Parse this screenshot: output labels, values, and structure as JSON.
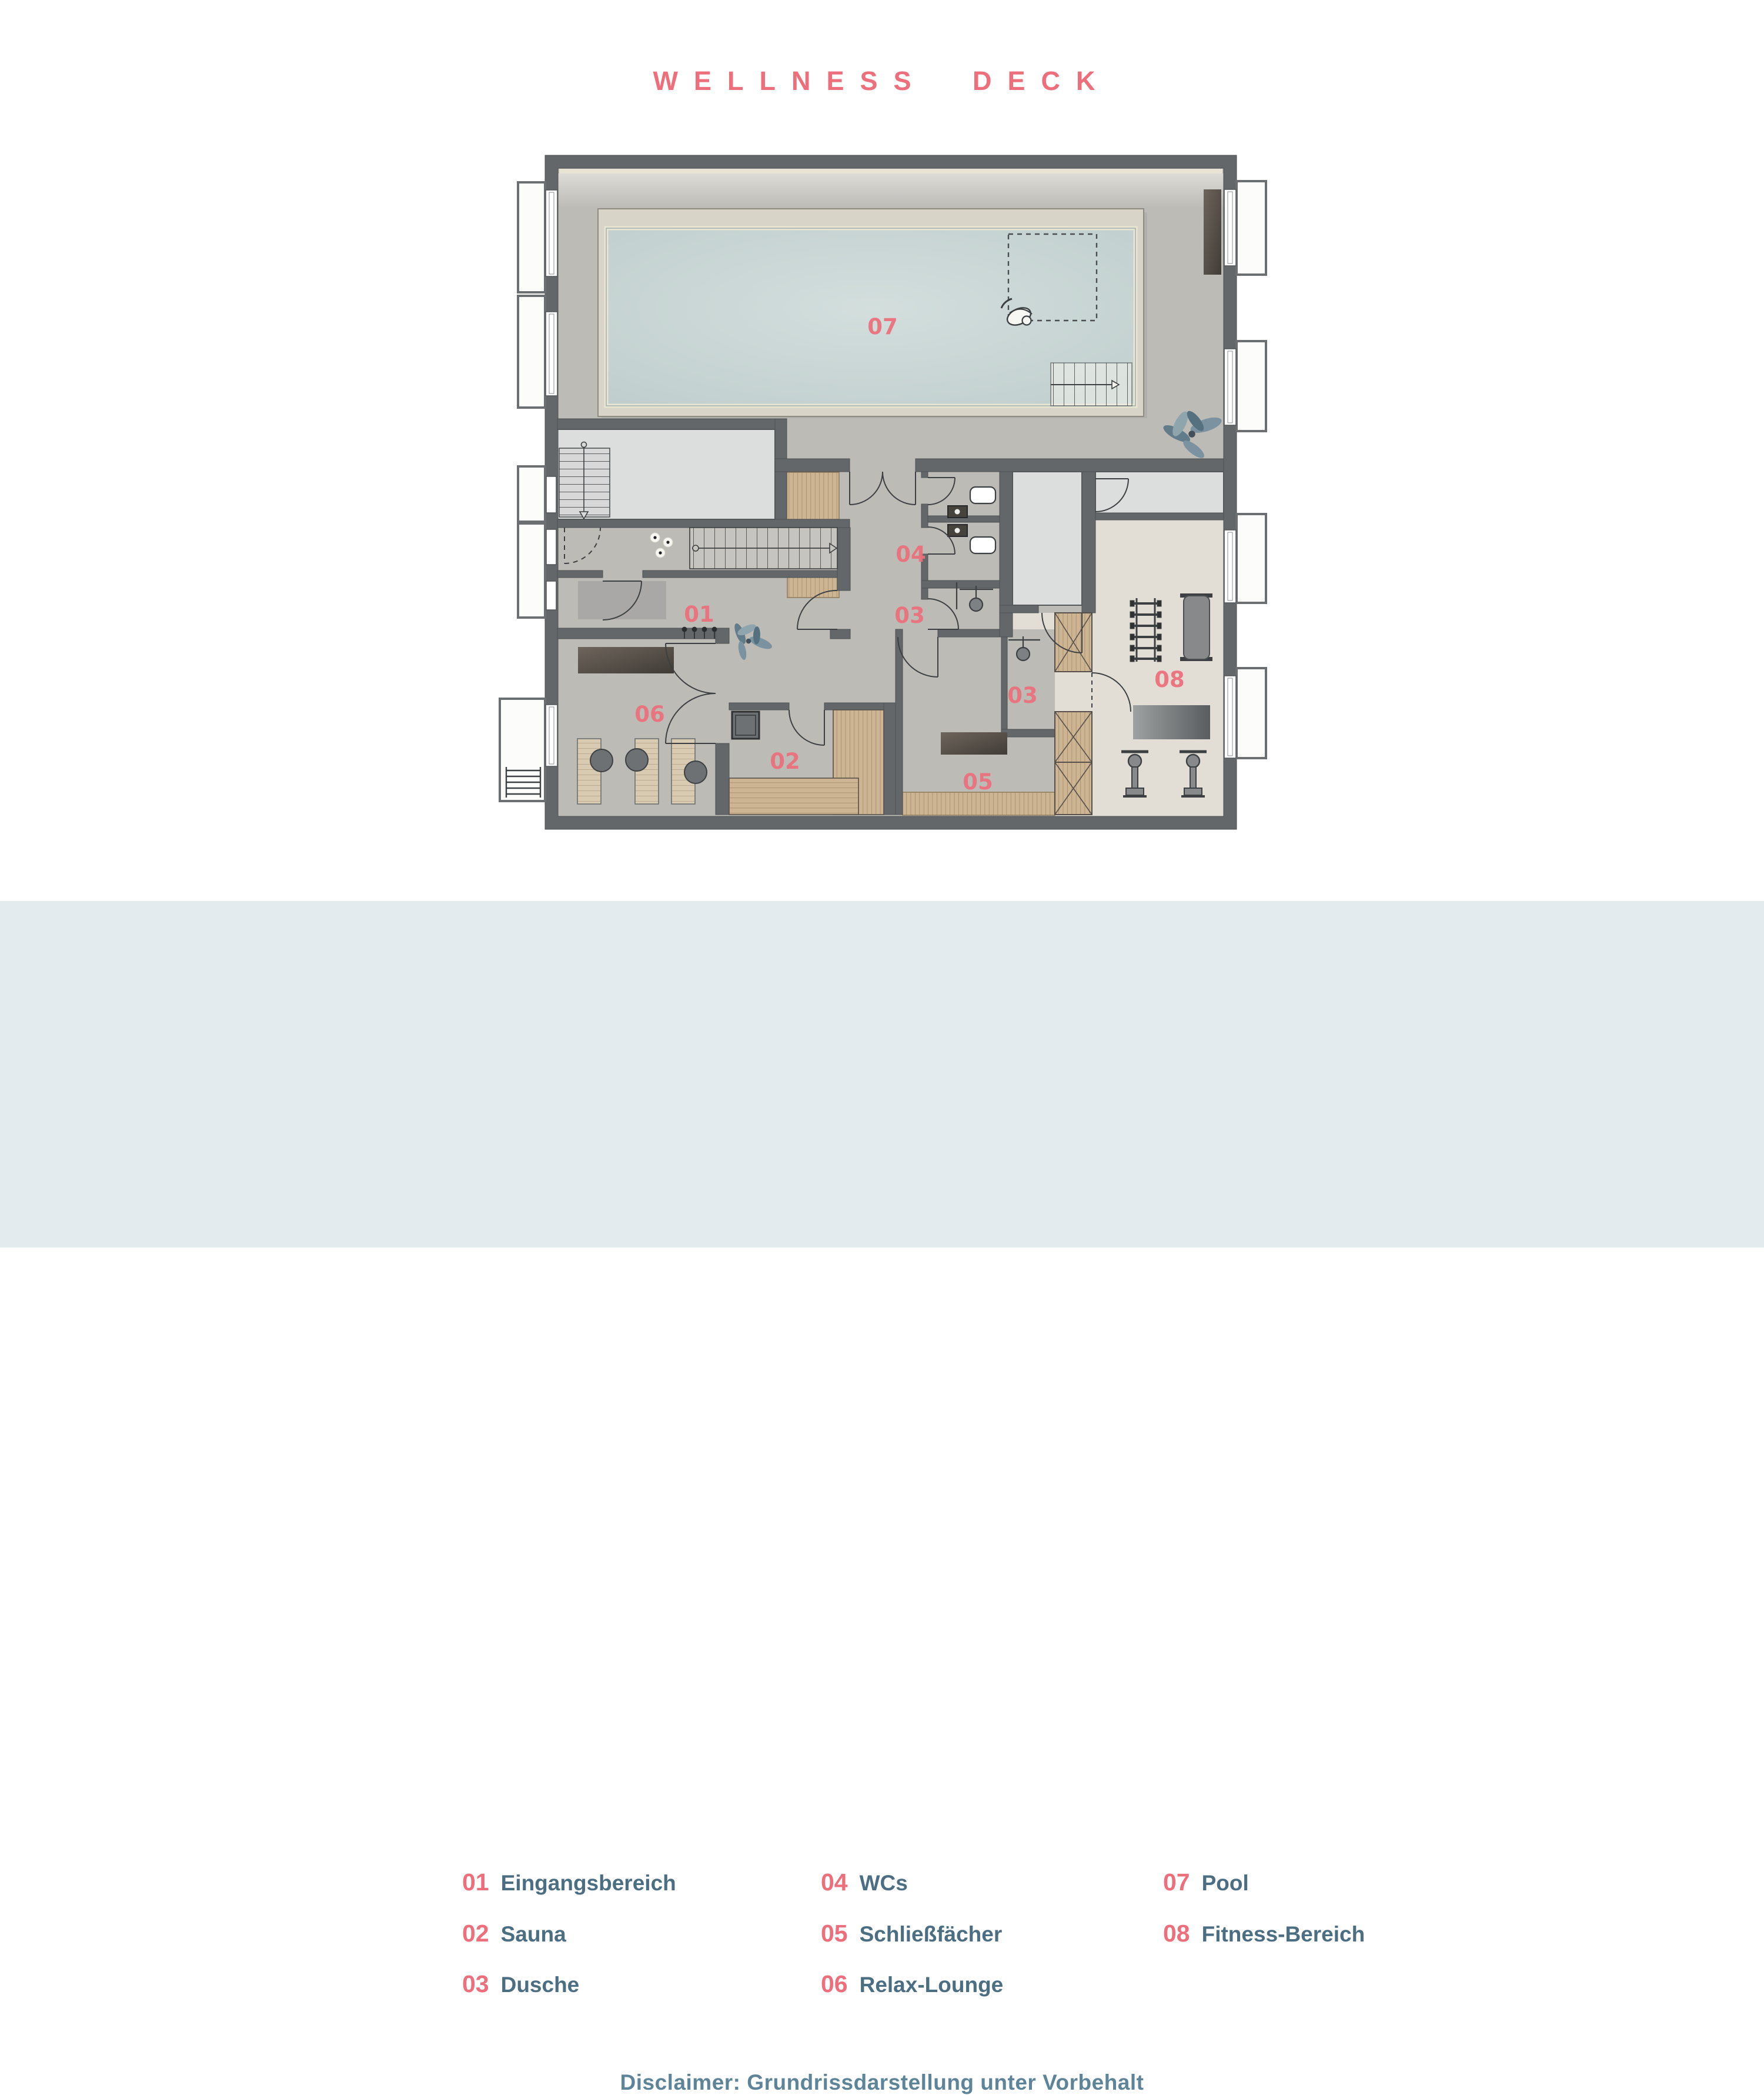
{
  "title": "WELLNESS DECK",
  "legend": {
    "items": [
      {
        "num": "01",
        "label": "Eingangsbereich"
      },
      {
        "num": "02",
        "label": "Sauna"
      },
      {
        "num": "03",
        "label": "Dusche"
      },
      {
        "num": "04",
        "label": "WCs"
      },
      {
        "num": "05",
        "label": "Schließfächer"
      },
      {
        "num": "06",
        "label": "Relax-Lounge"
      },
      {
        "num": "07",
        "label": "Pool"
      },
      {
        "num": "08",
        "label": "Fitness-Bereich"
      }
    ]
  },
  "disclaimer": "Disclaimer: Grundrissdarstellung unter Vorbehalt",
  "plan": {
    "rooms": [
      {
        "id": "eingangsbereich",
        "num": "01"
      },
      {
        "id": "sauna",
        "num": "02"
      },
      {
        "id": "dusche-upper",
        "num": "03"
      },
      {
        "id": "dusche-lower",
        "num": "03"
      },
      {
        "id": "wcs",
        "num": "04"
      },
      {
        "id": "schliessfaecher",
        "num": "05"
      },
      {
        "id": "relax-lounge",
        "num": "06"
      },
      {
        "id": "pool",
        "num": "07"
      },
      {
        "id": "fitness-bereich",
        "num": "08"
      }
    ]
  },
  "colors": {
    "accent": "#ec6f7b",
    "legendText": "#4c6e82",
    "disclaimerText": "#5d8498",
    "legendBand": "#e4ebee",
    "wall": "#636769",
    "floor": "#bdbbb6",
    "lightRoom": "#dcdddd",
    "fitnessFloor": "#e2ded6",
    "wood": "#cdb593",
    "water": "#c7d4d4",
    "deck": "#d8d4c7"
  }
}
